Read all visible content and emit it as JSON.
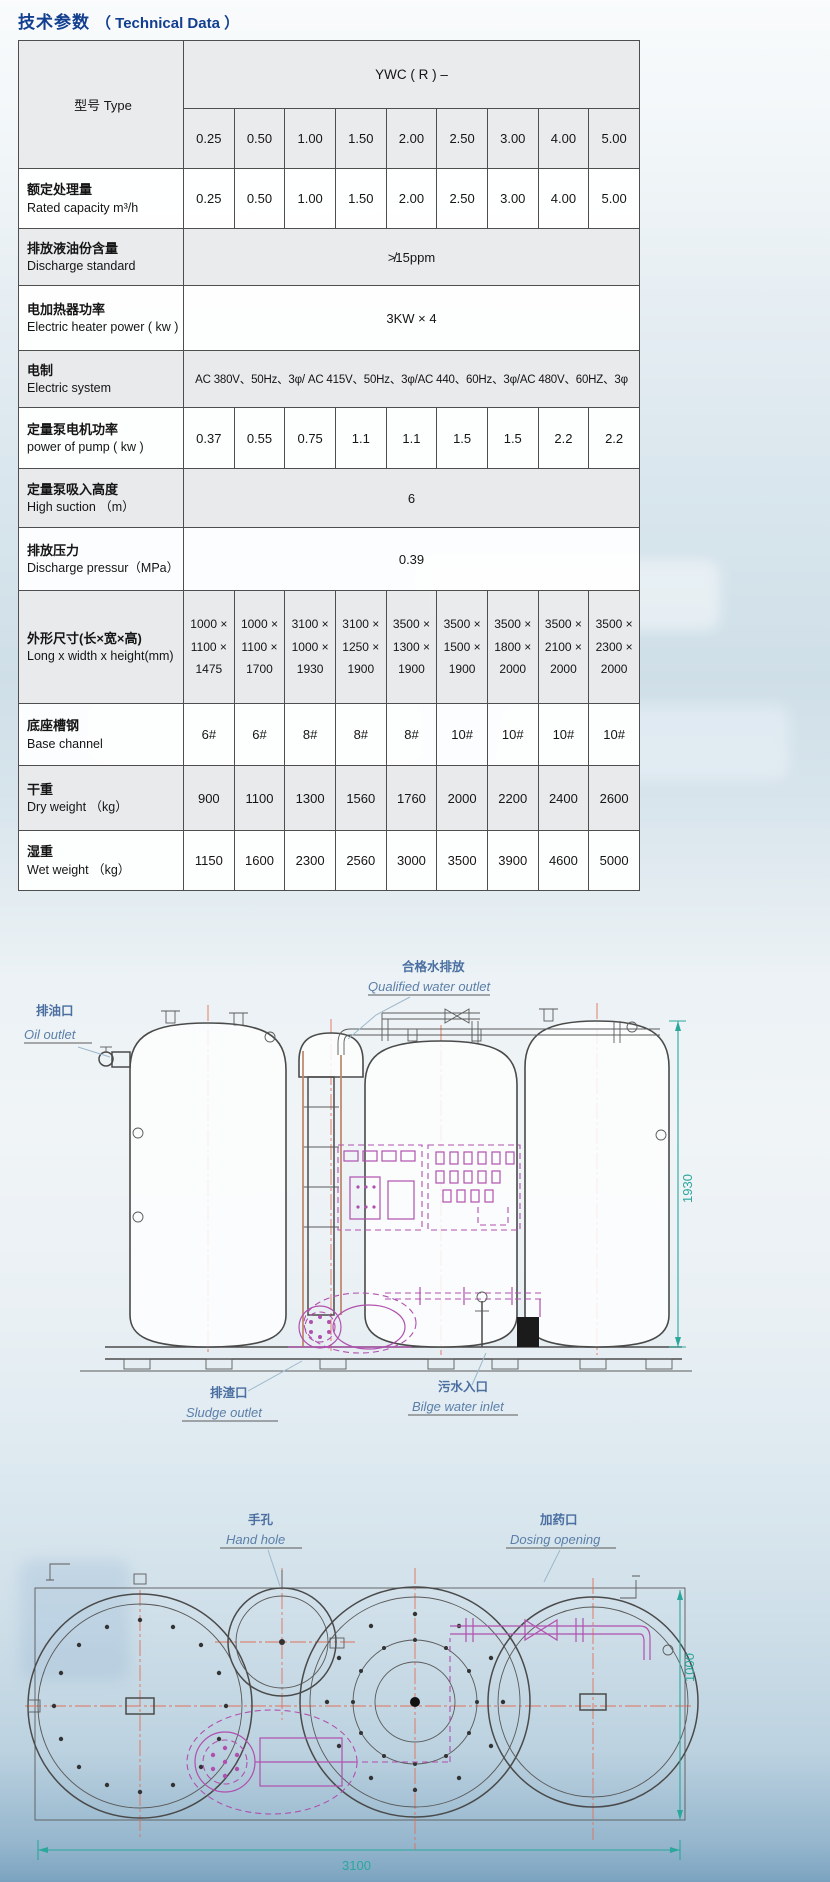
{
  "title": {
    "zh": "技术参数",
    "en": "（ Technical Data ）"
  },
  "colors": {
    "title_blue": "#123f8f",
    "dimension_teal": "#2ba79b",
    "callout_blue": "#5b7fa8",
    "equipment_magenta": "#b050ae",
    "pipe_salmon": "#c08a6f",
    "centerline_red": "#e0715a"
  },
  "table": {
    "type_header": "型号 Type",
    "series_header": "YWC ( R ) –",
    "models": [
      "0.25",
      "0.50",
      "1.00",
      "1.50",
      "2.00",
      "2.50",
      "3.00",
      "4.00",
      "5.00"
    ],
    "rows": [
      {
        "label_zh": "额定处理量",
        "label_en": "Rated capacity  m³/h",
        "values": [
          "0.25",
          "0.50",
          "1.00",
          "1.50",
          "2.00",
          "2.50",
          "3.00",
          "4.00",
          "5.00"
        ]
      },
      {
        "label_zh": "排放液油份含量",
        "label_en": "Discharge standard",
        "merged": "≯15ppm"
      },
      {
        "label_zh": "电加热器功率",
        "label_en": "Electric heater power ( kw )",
        "merged": "3KW × 4"
      },
      {
        "label_zh": "电制",
        "label_en": "Electric system",
        "merged": "AC 380V、50Hz、3φ/ AC 415V、50Hz、3φ/AC 440、60Hz、3φ/AC 480V、60HZ、3φ"
      },
      {
        "label_zh": "定量泵电机功率",
        "label_en": "power of pump ( kw )",
        "values": [
          "0.37",
          "0.55",
          "0.75",
          "1.1",
          "1.1",
          "1.5",
          "1.5",
          "2.2",
          "2.2"
        ]
      },
      {
        "label_zh": "定量泵吸入高度",
        "label_en": "High suction （m）",
        "merged": "6"
      },
      {
        "label_zh": "排放压力",
        "label_en": "Discharge pressur（MPa）",
        "merged": "0.39"
      },
      {
        "label_zh": "外形尺寸(长×宽×高)",
        "label_en": "Long x width x height(mm)",
        "values": [
          "1000 ×\n1100 ×\n1475",
          "1000 ×\n1100 ×\n1700",
          "3100 ×\n1000 ×\n1930",
          "3100 ×\n1250 ×\n1900",
          "3500 ×\n1300 ×\n1900",
          "3500 ×\n1500 ×\n1900",
          "3500 ×\n1800 ×\n2000",
          "3500 ×\n2100 ×\n2000",
          "3500 ×\n2300 ×\n2000"
        ]
      },
      {
        "label_zh": "底座槽钢",
        "label_en": "Base channel",
        "values": [
          "6#",
          "6#",
          "8#",
          "8#",
          "8#",
          "10#",
          "10#",
          "10#",
          "10#"
        ]
      },
      {
        "label_zh": "干重",
        "label_en": "Dry weight （kg）",
        "values": [
          "900",
          "1100",
          "1300",
          "1560",
          "1760",
          "2000",
          "2200",
          "2400",
          "2600"
        ]
      },
      {
        "label_zh": "湿重",
        "label_en": "Wet weight （kg）",
        "values": [
          "1150",
          "1600",
          "2300",
          "2560",
          "3000",
          "3500",
          "3900",
          "4600",
          "5000"
        ]
      }
    ]
  },
  "elevation": {
    "labels": {
      "qualified_zh": "合格水排放",
      "qualified_en": "Qualified water outlet",
      "oil_zh": "排油口",
      "oil_en": "Oil outlet",
      "sludge_zh": "排渣口",
      "sludge_en": "Sludge outlet",
      "bilge_zh": "污水入口",
      "bilge_en": "Bilge water inlet",
      "height_dim": "1930"
    }
  },
  "plan": {
    "labels": {
      "hand_zh": "手孔",
      "hand_en": "Hand hole",
      "dosing_zh": "加药口",
      "dosing_en": "Dosing opening",
      "length_dim": "3100",
      "width_dim": "1000"
    }
  }
}
